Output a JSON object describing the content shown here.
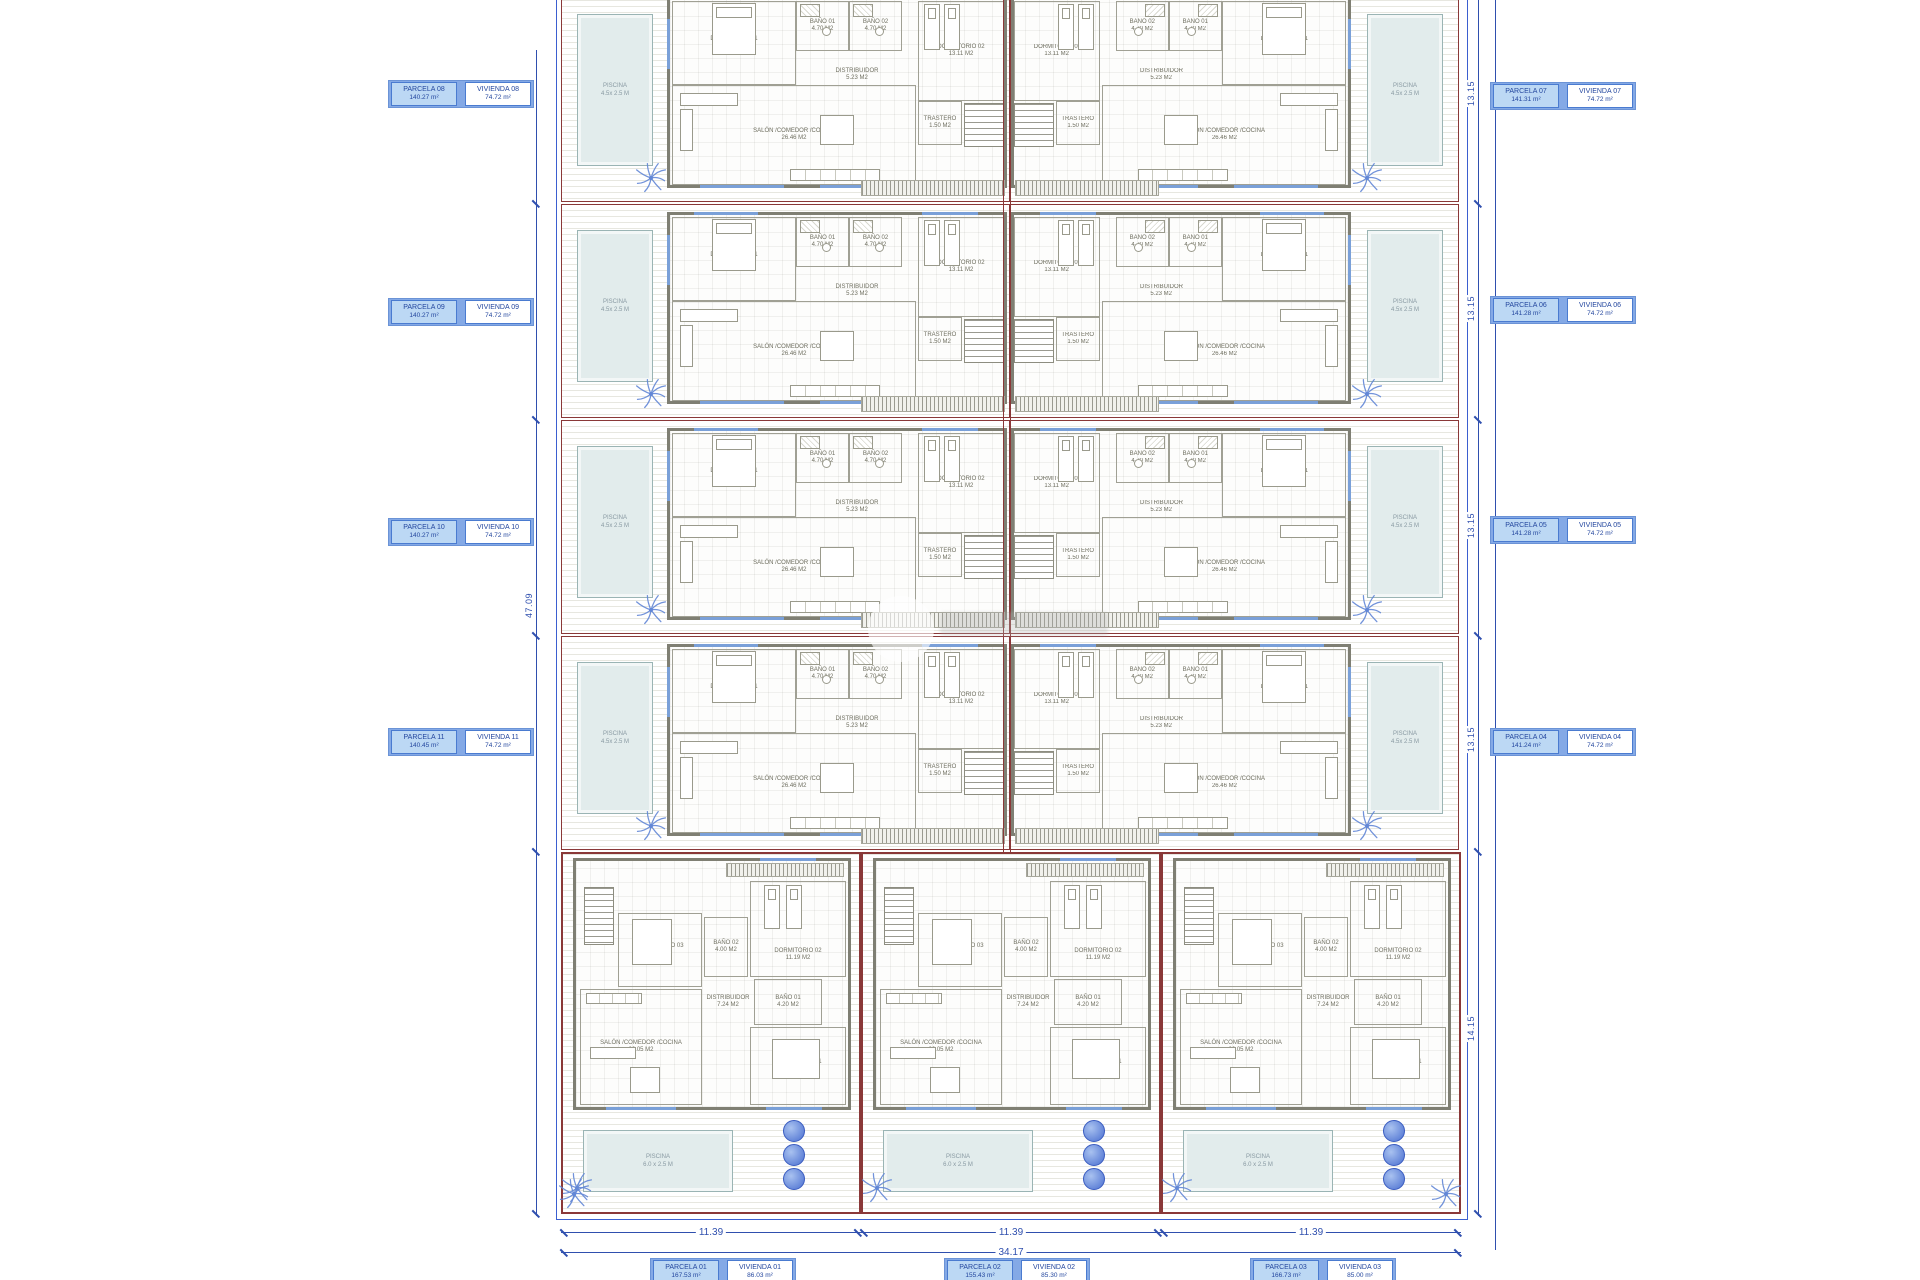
{
  "site": {
    "left_labels": [
      {
        "parcela": "PARCELA 08",
        "parcela_area": "140.27 m²",
        "vivienda": "VIVIENDA 08",
        "vivienda_area": "74.72 m²"
      },
      {
        "parcela": "PARCELA 09",
        "parcela_area": "140.27 m²",
        "vivienda": "VIVIENDA 09",
        "vivienda_area": "74.72 m²"
      },
      {
        "parcela": "PARCELA 10",
        "parcela_area": "140.27 m²",
        "vivienda": "VIVIENDA 10",
        "vivienda_area": "74.72 m²"
      },
      {
        "parcela": "PARCELA 11",
        "parcela_area": "140.45 m²",
        "vivienda": "VIVIENDA 11",
        "vivienda_area": "74.72 m²"
      }
    ],
    "right_labels": [
      {
        "parcela": "PARCELA 07",
        "parcela_area": "141.31 m²",
        "vivienda": "VIVIENDA 07",
        "vivienda_area": "74.72 m²"
      },
      {
        "parcela": "PARCELA 06",
        "parcela_area": "141.28 m²",
        "vivienda": "VIVIENDA 06",
        "vivienda_area": "74.72 m²"
      },
      {
        "parcela": "PARCELA 05",
        "parcela_area": "141.28 m²",
        "vivienda": "VIVIENDA 05",
        "vivienda_area": "74.72 m²"
      },
      {
        "parcela": "PARCELA 04",
        "parcela_area": "141.24 m²",
        "vivienda": "VIVIENDA 04",
        "vivienda_area": "74.72 m²"
      }
    ],
    "bottom_labels": [
      {
        "parcela": "PARCELA 01",
        "parcela_area": "167.53 m²",
        "vivienda": "VIVIENDA 01",
        "vivienda_area": "86.03 m²"
      },
      {
        "parcela": "PARCELA 02",
        "parcela_area": "155.43 m²",
        "vivienda": "VIVIENDA 02",
        "vivienda_area": "85.30 m²"
      },
      {
        "parcela": "PARCELA 03",
        "parcela_area": "166.73 m²",
        "vivienda": "VIVIENDA 03",
        "vivienda_area": "85.00 m²"
      }
    ]
  },
  "top_unit_rooms": [
    {
      "label": "DORMITORIO 01",
      "area": "11.72 M2"
    },
    {
      "label": "BAÑO 01",
      "area": "4.70 M2"
    },
    {
      "label": "BAÑO 02",
      "area": "4.70 M2"
    },
    {
      "label": "DORMITORIO 02",
      "area": "13.11 M2"
    },
    {
      "label": "DISTRIBUIDOR",
      "area": "5.23 M2"
    },
    {
      "label": "SALÓN /COMEDOR /COCINA",
      "area": "26.46 M2"
    },
    {
      "label": "TRASTERO",
      "area": "1.50 M2"
    }
  ],
  "bottom_unit_rooms": [
    {
      "label": "DORMITORIO 02",
      "area": "11.19 M2"
    },
    {
      "label": "DORMITORIO 03",
      "area": "8.97 M2"
    },
    {
      "label": "BAÑO 02",
      "area": "4.00 M2"
    },
    {
      "label": "BAÑO 01",
      "area": "4.20 M2"
    },
    {
      "label": "DISTRIBUIDOR",
      "area": "7.24 M2"
    },
    {
      "label": "SALÓN /COMEDOR /COCINA",
      "area": "26.05 M2"
    },
    {
      "label": "DORMITORIO 01",
      "area": "10.21 M2"
    }
  ],
  "pools": {
    "top_line1": "PISCINA",
    "top_line2": "4.5x 2.5 M",
    "bottom_line1": "PISCINA",
    "bottom_line2": "6.0 x 2.5 M"
  },
  "dimensions": {
    "bottom_segments": [
      "11.39",
      "11.39",
      "11.39"
    ],
    "bottom_total": "34.17",
    "right_row": "13.15",
    "right_bottom": "14.15",
    "left_total": "47.09"
  },
  "colors": {
    "parcel_line": "#8a3838",
    "dim_blue": "#2f4fae",
    "label_blue": "#84a9e6",
    "pool_fill": "#e2ecec",
    "wall_gray": "#7f7f73",
    "palm_blue": "#6287d6"
  }
}
